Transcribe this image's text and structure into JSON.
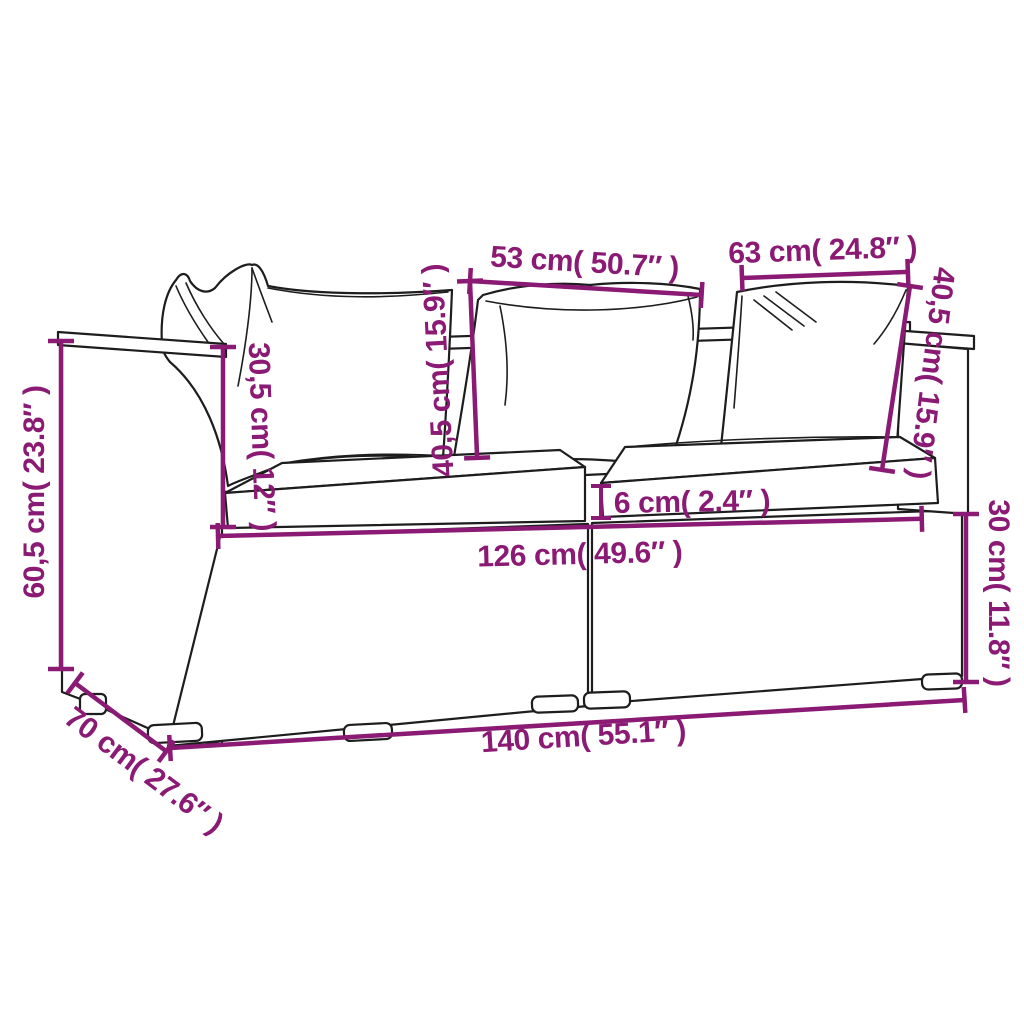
{
  "colors": {
    "dimension_line": "#8a1a73",
    "line_art": "#1d1d1d",
    "background": "#ffffff"
  },
  "diagram": {
    "type": "product-dimension-diagram",
    "subject": "poly-rattan-2-seater-garden-sofa-with-cushions",
    "dims": {
      "d53": "53 cm( 50.7″ )",
      "d63": "63 cm( 24.8″ )",
      "d40l": "40,5 cm( 15.9″ )",
      "d40r": "40,5 cm( 15.9″ )",
      "d30_5": "30,5 cm( 12″ )",
      "d60_5": "60,5 cm( 23.8″ )",
      "d70": "70 cm( 27.6″ )",
      "d6": "6 cm( 2.4″ )",
      "d126": "126 cm( 49.6″ )",
      "d140": "140 cm( 55.1″ )",
      "d30": "30 cm( 11.8″ )"
    }
  }
}
